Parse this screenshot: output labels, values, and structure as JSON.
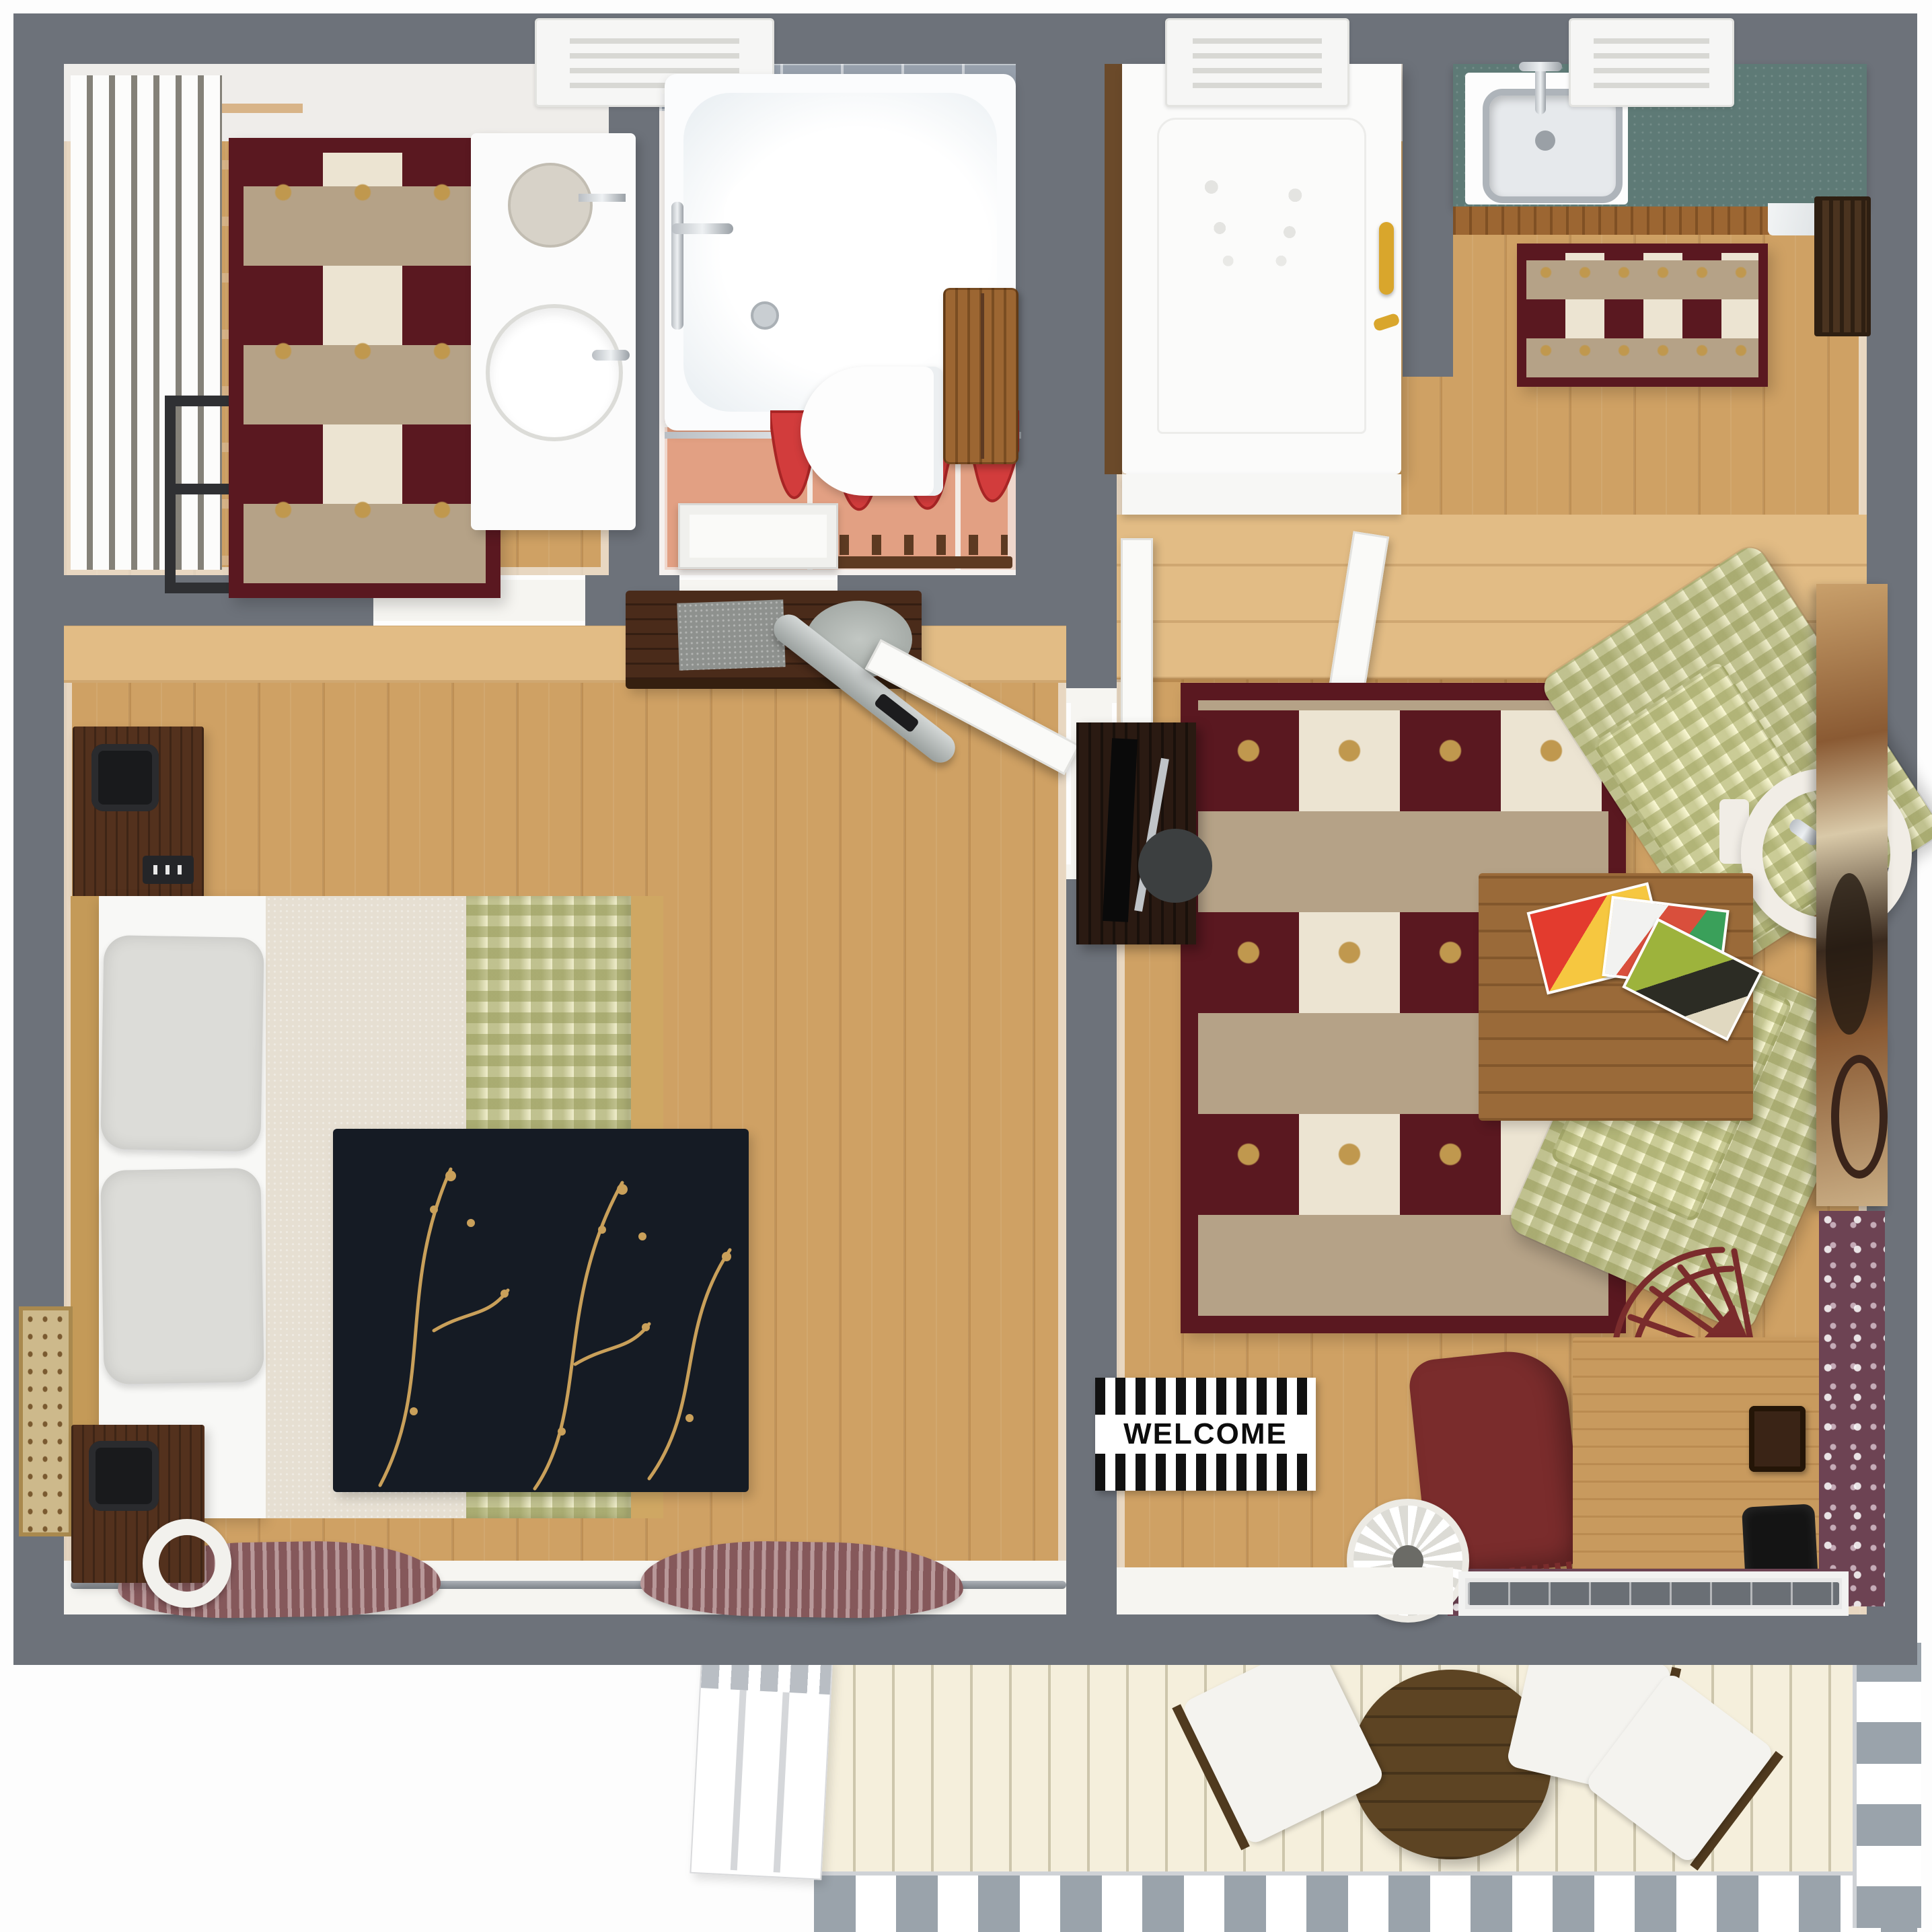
{
  "scene": {
    "description": "Top-down 3D rendered floor plan of a one-bedroom apartment with bathroom, dressing room, kitchen, living room and balcony"
  },
  "welcome_mat": {
    "text": "WELCOME"
  },
  "colors": {
    "wall": "#6d727a",
    "ivory": "#f6f5f1",
    "floor": "#cfa164",
    "hallway": "#e2bc85",
    "tile": "#e2a083",
    "grout": "#f3ece6",
    "blueTile": "#97a0ac",
    "counter": "#5e7a76",
    "cabinetWood": "#9c6632",
    "rugMaroon": "#5a1820",
    "rugTan": "#b5a287",
    "rugCream": "#ece4d2",
    "rugGold": "#c0984e",
    "ginghamBase": "#efedcb",
    "blackRug": "#151b24",
    "vineGold": "#c9a05a",
    "bedCream": "#e6dfd2",
    "pillow": "#dcdcd8",
    "bedFrame": "#c49a58",
    "deck": "#f5efdc",
    "railing": "#9aa3ab",
    "balconyTable": "#5d4423",
    "paisley": "#6d4353",
    "curtainRed": "#d23c3c",
    "mauve": "#9d7072",
    "gold": "#d9a62c",
    "darkWood": "#4a2b1a",
    "nightstand": "#53311d",
    "deskLight": "#c89a5e",
    "maroonChair": "#7a2c2c"
  },
  "rooms": [
    {
      "id": "dressing-room",
      "items": [
        "slatted-closet",
        "ladder-rack",
        "metal-rack",
        "checkered-rug",
        "vanity-with-double-sink",
        "ceiling-vent"
      ]
    },
    {
      "id": "bathroom",
      "items": [
        "bathtub",
        "shower-curtain",
        "toilet",
        "wall-cabinet",
        "coat-hook-rack",
        "door"
      ]
    },
    {
      "id": "bedroom",
      "items": [
        "double-bed",
        "pillows",
        "nightstand-with-lamp",
        "second-nightstand",
        "desk",
        "ironing-board",
        "floral-rug",
        "window-curtains",
        "wall-art",
        "door"
      ]
    },
    {
      "id": "entry-hall",
      "items": [
        "white-wardrobe",
        "gold-handle",
        "ledge",
        "ceiling-vent"
      ]
    },
    {
      "id": "kitchen",
      "items": [
        "teal-countertop",
        "sink",
        "cabinet-front",
        "small-checkered-rug",
        "wall-grille",
        "ceiling-vent"
      ]
    },
    {
      "id": "living-room",
      "items": [
        "large-checkered-rug",
        "tv-cabinet",
        "two-gingham-armchairs",
        "ring-floor-lamp",
        "coffee-table-with-magazines",
        "abstract-painting",
        "rocking-chairs",
        "writing-desk",
        "paisley-runners",
        "welcome-mat",
        "pet-bowl",
        "balcony-door"
      ]
    },
    {
      "id": "balcony",
      "items": [
        "deck",
        "railing",
        "stairs",
        "round-table",
        "three-chairs"
      ]
    }
  ]
}
